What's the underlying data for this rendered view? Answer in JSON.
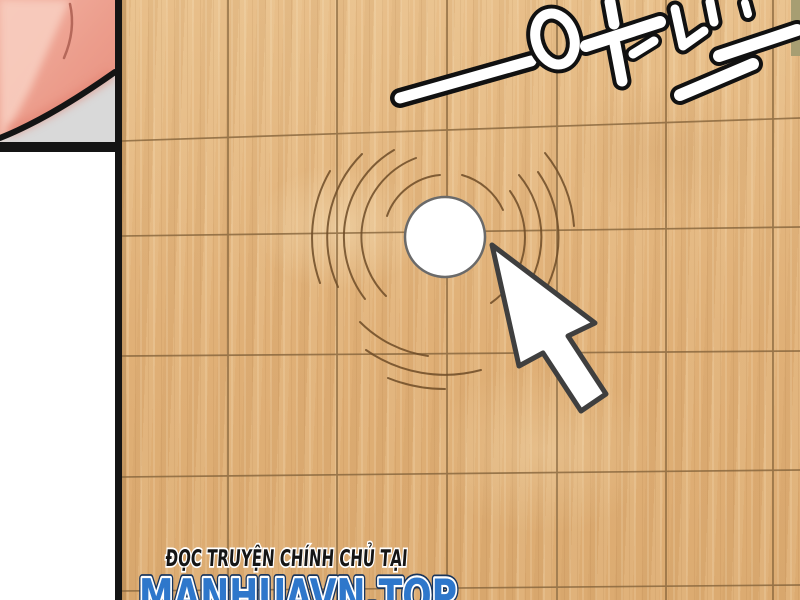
{
  "scene": {
    "type": "comic-panel",
    "left_gutter": {
      "background": "#ffffff",
      "prev_panel": {
        "skin_pink": "#ec9d8c",
        "skin_pink_light": "#f8cdbf",
        "shadow_gray": "#d9d9d9",
        "border_black": "#141414"
      }
    },
    "board": {
      "wood_color": "#e3b77e",
      "grid_line_color": "#86653c",
      "edge_strip_color": "#a79e72"
    },
    "click_effect": {
      "marker_fill": "#ffffff",
      "marker_outline": "#6a6a6a",
      "ripple_color": "#6e4c27"
    },
    "cursor": {
      "fill": "#ffffff",
      "outline": "#3f3f3f"
    },
    "sfx": {
      "text": "咔哒",
      "dash": "—",
      "style": "white-fill-black-outline"
    },
    "footer": {
      "line1": "ĐỌC TRUYỆN CHÍNH CHỦ TẠI",
      "line1_color": "#151515",
      "line2": "MANHUAVN.TOP",
      "line2_color": "#2e77cb",
      "outline_color": "#ffffff"
    }
  }
}
